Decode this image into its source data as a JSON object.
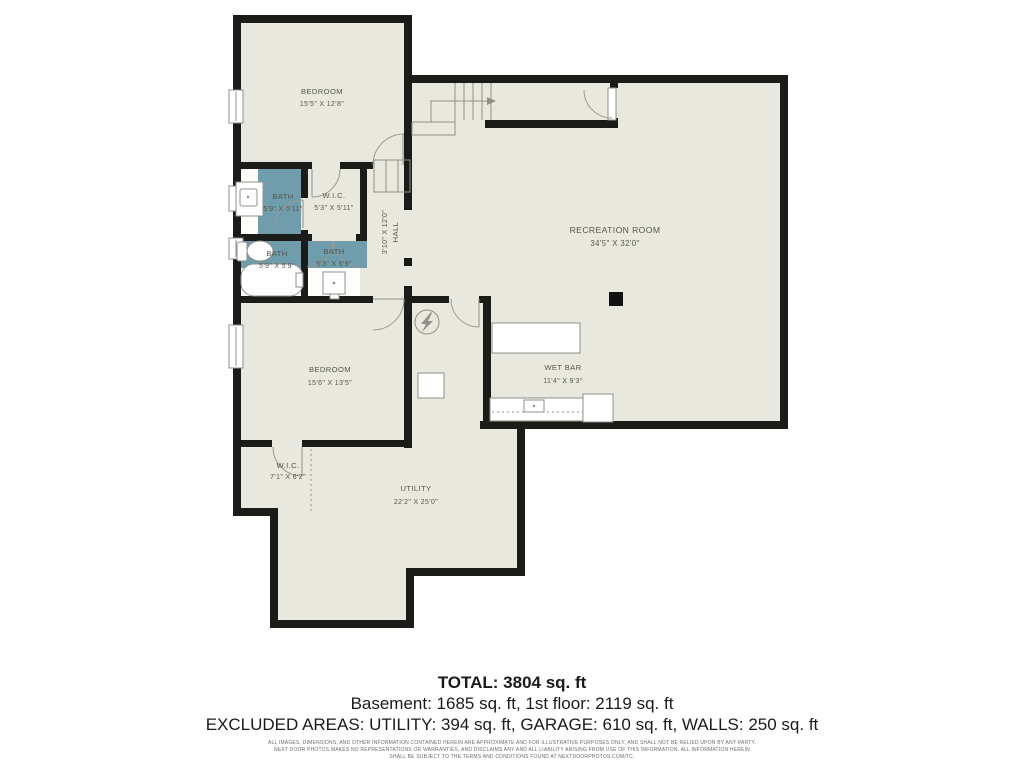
{
  "floor_plan": {
    "rooms": [
      {
        "id": "bedroom-upper",
        "name": "BEDROOM",
        "dims": "15'5\" X 12'8\""
      },
      {
        "id": "bath-upper",
        "name": "BATH",
        "dims": "5'9\" X 5'11\""
      },
      {
        "id": "wic-upper",
        "name": "W.I.C.",
        "dims": "5'3\" X 5'11\""
      },
      {
        "id": "hall",
        "name": "HALL",
        "dims": "3'10\" X 12'0\""
      },
      {
        "id": "bath-lower-left",
        "name": "BATH",
        "dims": "5'9\" X 5'9\""
      },
      {
        "id": "bath-lower-right",
        "name": "BATH",
        "dims": "5'3\" X 5'9\""
      },
      {
        "id": "recreation-room",
        "name": "RECREATION ROOM",
        "dims": "34'5\" X 32'0\""
      },
      {
        "id": "wet-bar",
        "name": "WET BAR",
        "dims": "11'4\" X 9'3\""
      },
      {
        "id": "bedroom-lower",
        "name": "BEDROOM",
        "dims": "15'6\" X 13'5\""
      },
      {
        "id": "wic-lower",
        "name": "W.I.C.",
        "dims": "7'1\" X 6'2\""
      },
      {
        "id": "utility",
        "name": "UTILITY",
        "dims": "22'2\" X 25'0\""
      }
    ],
    "colors": {
      "floor": "#e9e8de",
      "bath_floor": "#6f9dab",
      "wall": "#1b1b18",
      "line": "#8f8f88",
      "label": "#55564e"
    }
  },
  "summary": {
    "total": "TOTAL: 3804 sq. ft",
    "floors": "Basement: 1685 sq. ft, 1st floor: 2119 sq. ft",
    "excluded": "EXCLUDED AREAS: UTILITY: 394 sq. ft, GARAGE: 610 sq. ft, WALLS: 250 sq. ft"
  },
  "disclaimer": {
    "line1": "ALL IMAGES, DIMENSIONS, AND OTHER INFORMATION CONTAINED HEREIN ARE APPROXIMATE AND FOR ILLUSTRATIVE PURPOSES ONLY, AND SHALL NOT BE RELIED UPON BY ANY PARTY.",
    "line2": "NEXT DOOR PHOTOS MAKES NO REPRESENTATIONS OR WARRANTIES, AND DISCLAIMS ANY AND ALL LIABILITY ARISING FROM USE OF THIS INFORMATION. ALL INFORMATION HEREIN",
    "line3": "SHALL BE SUBJECT TO THE TERMS AND CONDITIONS FOUND AT NEXTDOORPHOTOS.COM/TC."
  }
}
